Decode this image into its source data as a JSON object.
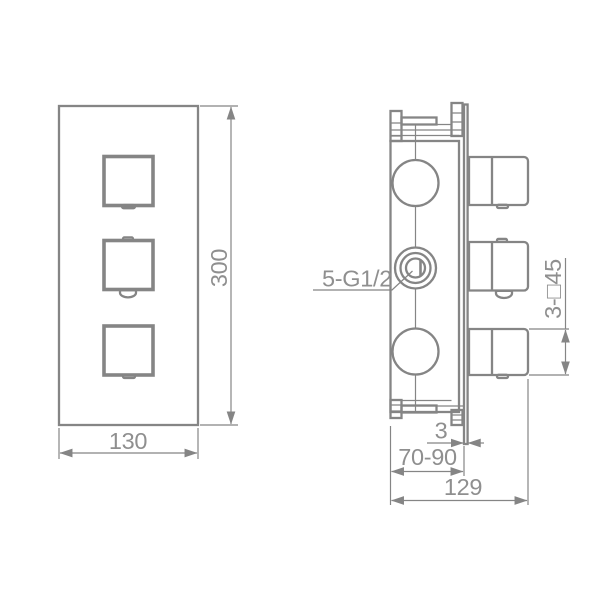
{
  "drawing": {
    "colors": {
      "background": "#ffffff",
      "line": "#858585",
      "text": "#8f8f8f"
    },
    "front_view": {
      "width_label": "130",
      "height_label": "300"
    },
    "side_view": {
      "ports_label": "5-G1/2",
      "handles_label": "3-□45",
      "plate_thickness_label": "3",
      "embed_depth_label": "70-90",
      "overall_depth_label": "129"
    }
  }
}
